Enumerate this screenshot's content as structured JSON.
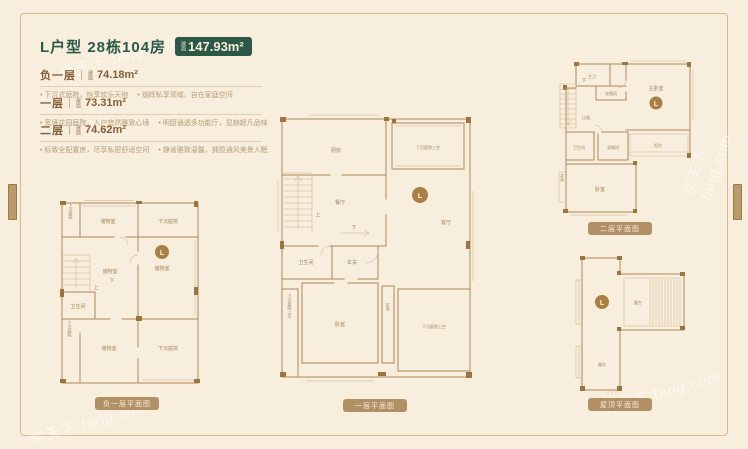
{
  "watermark": {
    "text": "房天下 fang.com"
  },
  "header": {
    "title": "L户型 28栋104房",
    "badge": {
      "prefix": "建面",
      "value": "147.93m²"
    }
  },
  "sections": [
    {
      "name": "负一层",
      "area_prefix": "建面",
      "area": "74.18m²",
      "desc1": "下沉式庭院，怡享欢乐天地",
      "desc2": "烟辉私享领域，自在家庭空间"
    },
    {
      "name": "一层",
      "area_prefix": "建面",
      "area": "73.31m²",
      "desc1": "宽境花园庭院，入户悠然雅致心境",
      "desc2": "明厨通透多功能厅，显赫超凡品味"
    },
    {
      "name": "二层",
      "area_prefix": "建面",
      "area": "74.62m²",
      "desc1": "标致全配置房，尽享私密舒适空间",
      "desc2": "静谧雅致温馨，拥揽通风美景入眠"
    }
  ],
  "plans": {
    "basement": {
      "caption": "负一层平面图",
      "badge": "L",
      "rooms": {
        "courtyard_small": "下沉庭院",
        "storage_top": "储物室",
        "courtyard_top": "下沉庭院",
        "storage_main": "储物室",
        "storage_left": "储物室",
        "bathroom": "卫生间",
        "storage_bottom": "储物室",
        "courtyard_bottom": "下沉庭院",
        "courtyard_left": "下沉庭院",
        "stairs_up": "上",
        "stairs_down": "下"
      }
    },
    "first": {
      "caption": "一层平面图",
      "badge": "L",
      "rooms": {
        "kitchen": "厨房",
        "void_top": "下沉庭院上空",
        "dining": "餐厅",
        "living": "客厅",
        "bathroom": "卫生间",
        "foyer": "玄关",
        "bedroom": "卧室",
        "planter": "花池",
        "void_bottom": "下沉庭院上空",
        "void_left": "下沉庭院上空",
        "stairs_up": "上",
        "stairs_down": "下"
      }
    },
    "second": {
      "caption": "二层平面图",
      "badge": "L",
      "rooms": {
        "master_bath": "主卫",
        "closet_top": "衣帽间",
        "master_bedroom": "主卧室",
        "hallway": "过道",
        "bathroom": "卫生间",
        "closet_mid": "衣帽间",
        "balcony": "阳台",
        "bedroom": "卧室",
        "planter": "花池",
        "stairs_down": "下"
      }
    },
    "roof": {
      "caption": "屋顶平面图",
      "badge": "L",
      "rooms": {
        "terrace_right": "露台",
        "terrace_bottom": "露台"
      }
    }
  }
}
